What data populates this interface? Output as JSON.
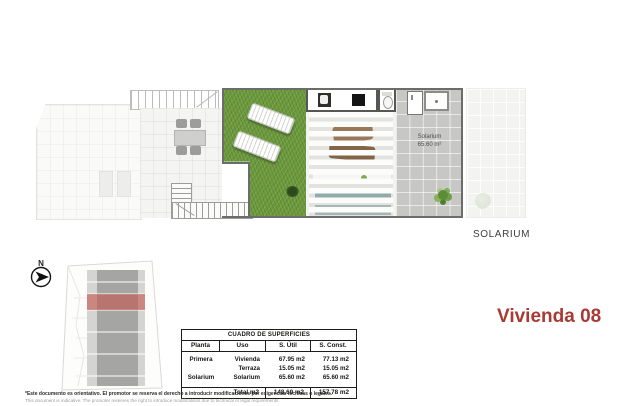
{
  "plan": {
    "solarium_label": {
      "line1": "Solarium",
      "line2": "65.60 m²"
    },
    "caption": "SOLARIUM"
  },
  "compass": {
    "label": "N"
  },
  "unit_title": "Vivienda 08",
  "surface_table": {
    "title": "CUADRO DE SUPERFICIES",
    "headers": [
      "Planta",
      "Uso",
      "S. Útil",
      "S. Const."
    ],
    "rows": [
      [
        "Primera",
        "Vivienda",
        "67.95 m2",
        "77.13 m2"
      ],
      [
        "",
        "Terraza",
        "15.05 m2",
        "15.05 m2"
      ],
      [
        "Solarium",
        "Solarium",
        "65.60 m2",
        "65.60 m2"
      ]
    ],
    "total": [
      "Total m2",
      "148.60 m2",
      "157.78 m2"
    ]
  },
  "disclaimer": {
    "es": "*Este documento es orientativo. El promotor se reserva el derecho a introducir modificaciones por exigencias técnicas o legales.",
    "en": "This document is indicative. The promoter reserves the right to introduce modifications due to technical or legal requirements."
  },
  "colors": {
    "accent_red": "#a93a33",
    "highlight_red": "#c4574f",
    "grass_green": "#6d9b3e",
    "tile_gray": "#c7c7c5"
  }
}
